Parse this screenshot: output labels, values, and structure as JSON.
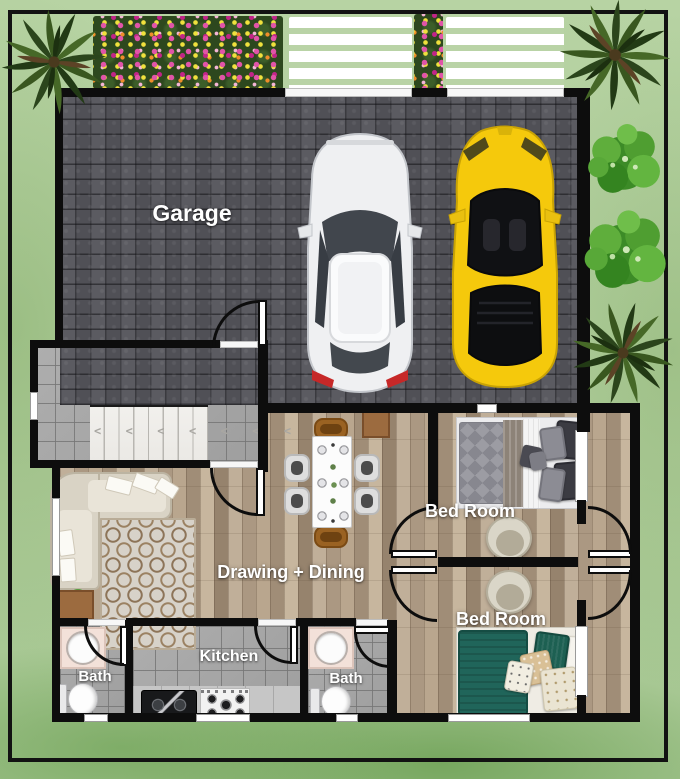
{
  "rooms": {
    "garage": {
      "label": "Garage"
    },
    "drawing_dining": {
      "label": "Drawing + Dining"
    },
    "bedroom_top": {
      "label": "Bed Room"
    },
    "bedroom_bottom": {
      "label": "Bed Room"
    },
    "kitchen": {
      "label": "Kitchen"
    },
    "bath_left": {
      "label": "Bath"
    },
    "bath_center": {
      "label": "Bath"
    }
  },
  "stairs": {
    "tread_marks": "< < < < < < <"
  },
  "palette": {
    "grass": "#b0cd9c",
    "grass_dark": "#8fbc7d",
    "wall": "#0d0d0d",
    "paver": "#55555a",
    "wood": "#b19e88",
    "tile": "#a8a8a8",
    "marble": "#f4f3f0",
    "white_car": "#eff0f2",
    "yellow_car": "#f5c90c",
    "teal_bed": "#20655a",
    "vanity_pink": "#f3e1d9",
    "label_text": "#ffffff"
  }
}
